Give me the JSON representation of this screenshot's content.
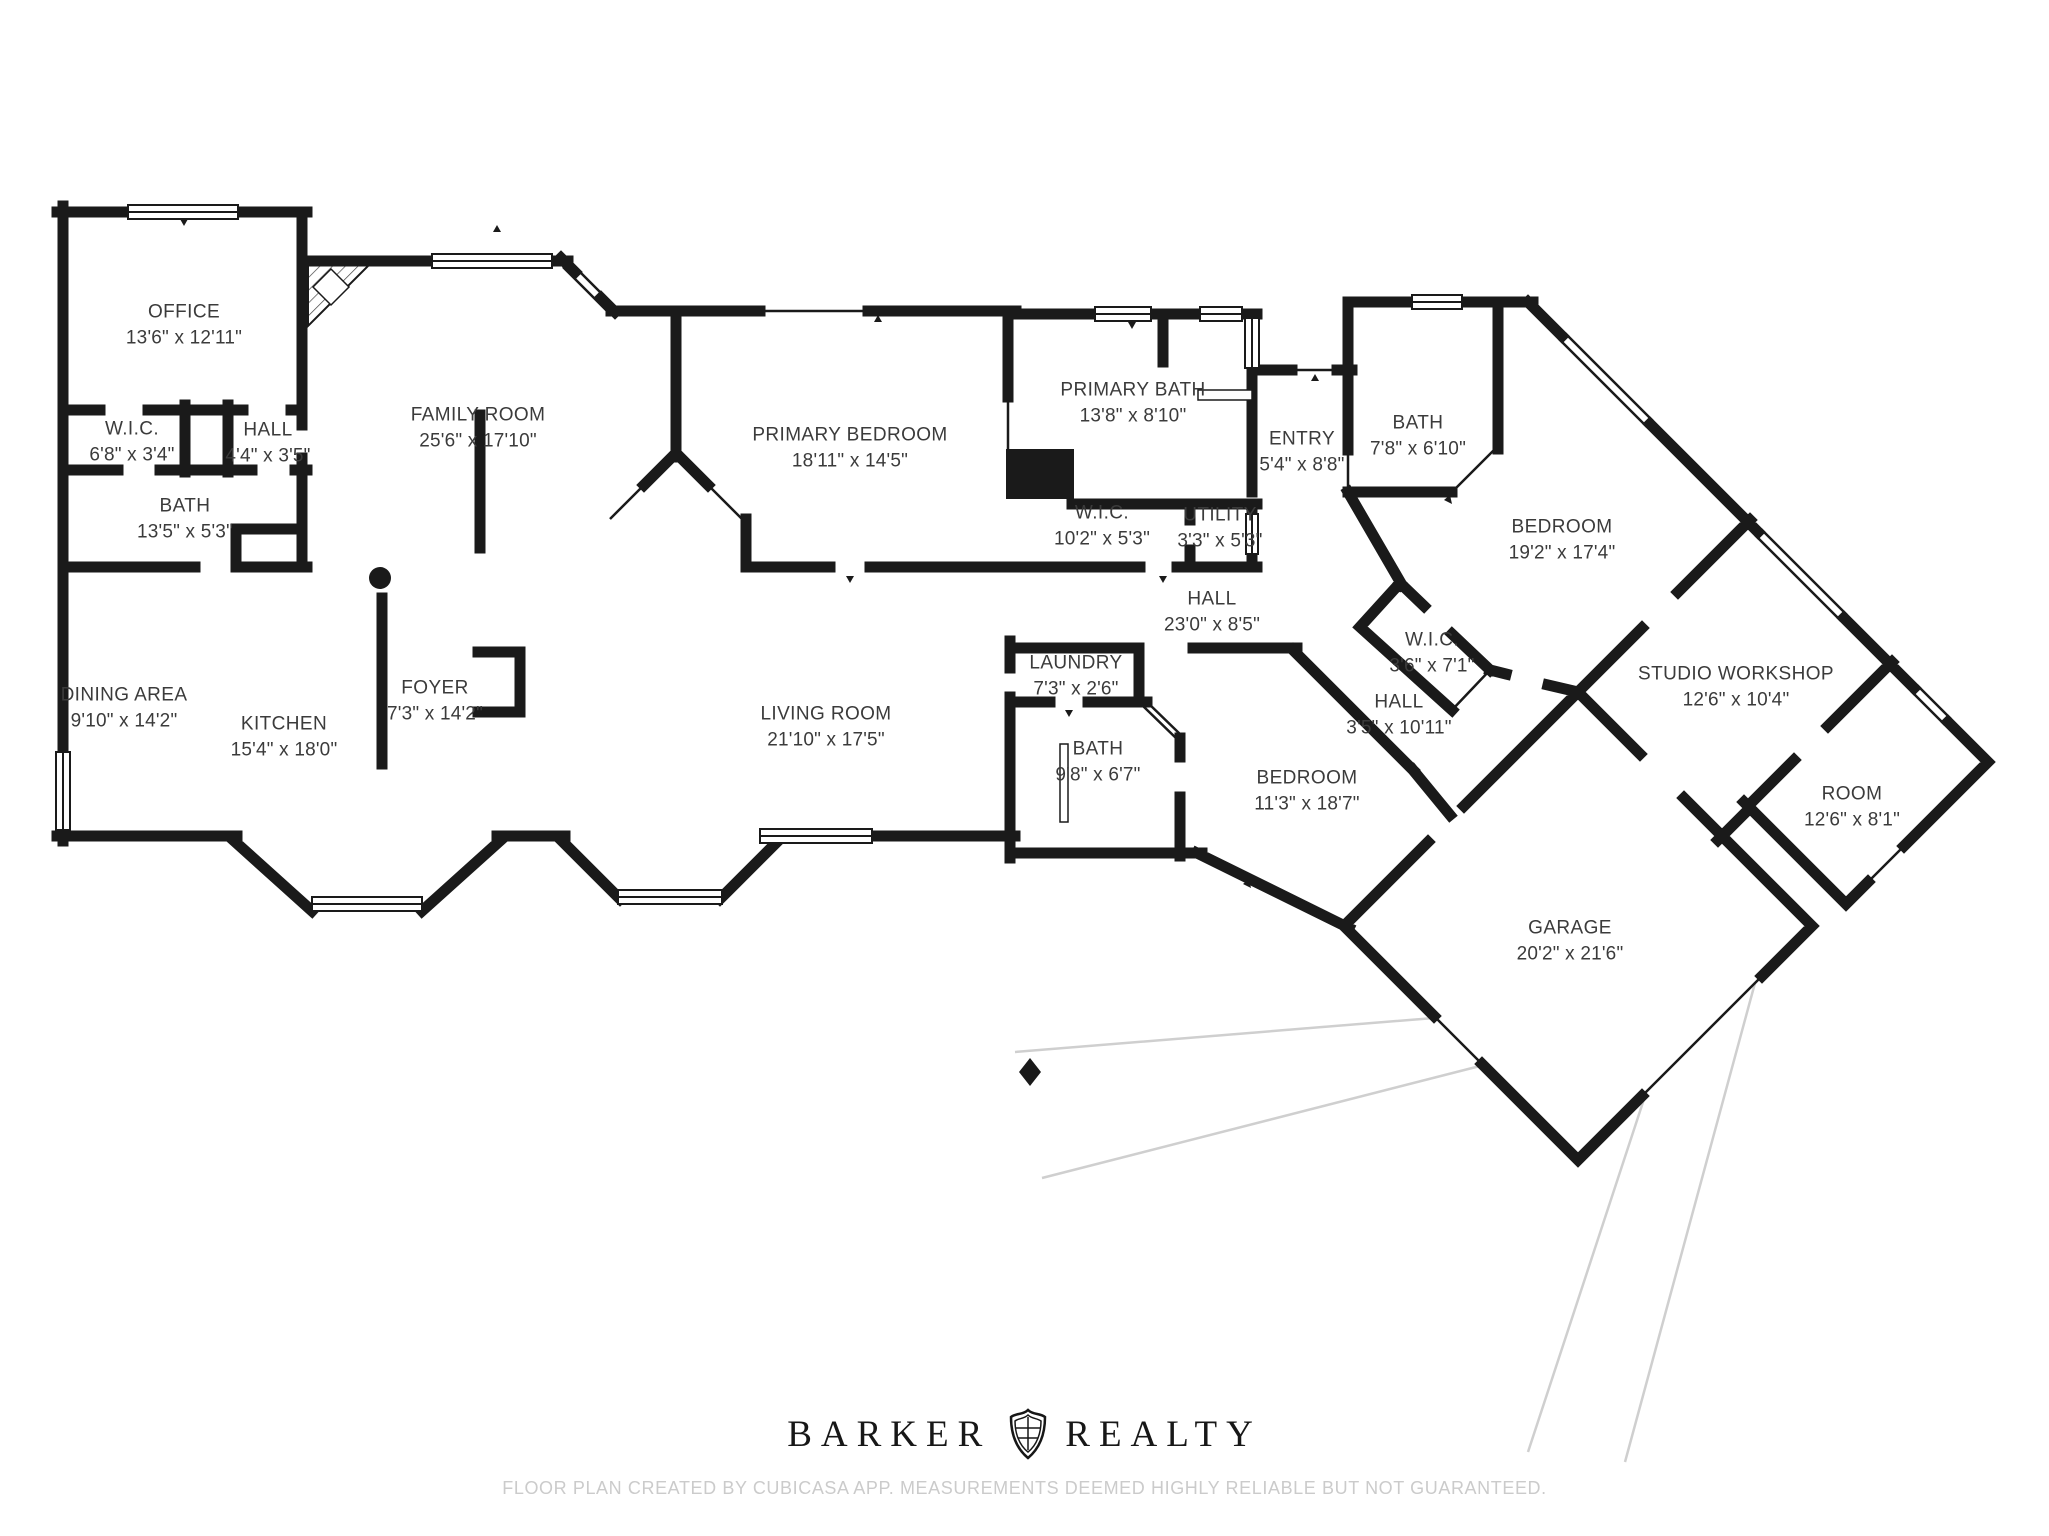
{
  "meta": {
    "background_color": "#ffffff",
    "wall_color": "#1a1a1a",
    "label_color": "#3b3b3b",
    "driveway_color": "#cfcfcf",
    "disclaimer_color": "#cbcbcb"
  },
  "rooms": [
    {
      "name": "OFFICE",
      "dims": "13'6\" x 12'11\"",
      "x": 184,
      "y": 325
    },
    {
      "name": "W.I.C.",
      "dims": "6'8\" x 3'4\"",
      "x": 132,
      "y": 442
    },
    {
      "name": "HALL",
      "dims": "4'4\" x 3'5\"",
      "x": 268,
      "y": 443
    },
    {
      "name": "BATH",
      "dims": "13'5\" x 5'3\"",
      "x": 185,
      "y": 519
    },
    {
      "name": "FAMILY ROOM",
      "dims": "25'6\" x 17'10\"",
      "x": 478,
      "y": 428
    },
    {
      "name": "PRIMARY BEDROOM",
      "dims": "18'11\" x 14'5\"",
      "x": 850,
      "y": 448
    },
    {
      "name": "PRIMARY BATH",
      "dims": "13'8\" x 8'10\"",
      "x": 1133,
      "y": 403
    },
    {
      "name": "W.I.C.",
      "dims": "10'2\" x 5'3\"",
      "x": 1102,
      "y": 526
    },
    {
      "name": "UTILITY",
      "dims": "3'3\" x 5'3\"",
      "x": 1220,
      "y": 528
    },
    {
      "name": "ENTRY",
      "dims": "5'4\" x 8'8\"",
      "x": 1302,
      "y": 452
    },
    {
      "name": "BATH",
      "dims": "7'8\" x 6'10\"",
      "x": 1418,
      "y": 436
    },
    {
      "name": "BEDROOM",
      "dims": "19'2\" x 17'4\"",
      "x": 1562,
      "y": 540
    },
    {
      "name": "HALL",
      "dims": "23'0\" x 8'5\"",
      "x": 1212,
      "y": 612
    },
    {
      "name": "W.I.C.",
      "dims": "3'6\" x 7'1\"",
      "x": 1432,
      "y": 653
    },
    {
      "name": "HALL",
      "dims": "3'5\" x 10'11\"",
      "x": 1399,
      "y": 715
    },
    {
      "name": "STUDIO WORKSHOP",
      "dims": "12'6\" x 10'4\"",
      "x": 1736,
      "y": 687
    },
    {
      "name": "ROOM",
      "dims": "12'6\" x 8'1\"",
      "x": 1852,
      "y": 807
    },
    {
      "name": "LAUNDRY",
      "dims": "7'3\" x 2'6\"",
      "x": 1076,
      "y": 676
    },
    {
      "name": "BATH",
      "dims": "9'8\" x 6'7\"",
      "x": 1098,
      "y": 762
    },
    {
      "name": "BEDROOM",
      "dims": "11'3\" x 18'7\"",
      "x": 1307,
      "y": 791
    },
    {
      "name": "GARAGE",
      "dims": "20'2\" x 21'6\"",
      "x": 1570,
      "y": 941
    },
    {
      "name": "DINING AREA",
      "dims": "9'10\" x 14'2\"",
      "x": 124,
      "y": 708
    },
    {
      "name": "KITCHEN",
      "dims": "15'4\" x 18'0\"",
      "x": 284,
      "y": 737
    },
    {
      "name": "FOYER",
      "dims": "7'3\" x 14'2\"",
      "x": 435,
      "y": 701
    },
    {
      "name": "LIVING ROOM",
      "dims": "21'10\" x 17'5\"",
      "x": 826,
      "y": 727
    }
  ],
  "footer": {
    "brand_left": "BARKER",
    "brand_right": "REALTY",
    "crest_icon": "realty-crest",
    "disclaimer": "FLOOR PLAN CREATED BY CUBICASA APP. MEASUREMENTS DEEMED HIGHLY RELIABLE BUT NOT GUARANTEED."
  }
}
